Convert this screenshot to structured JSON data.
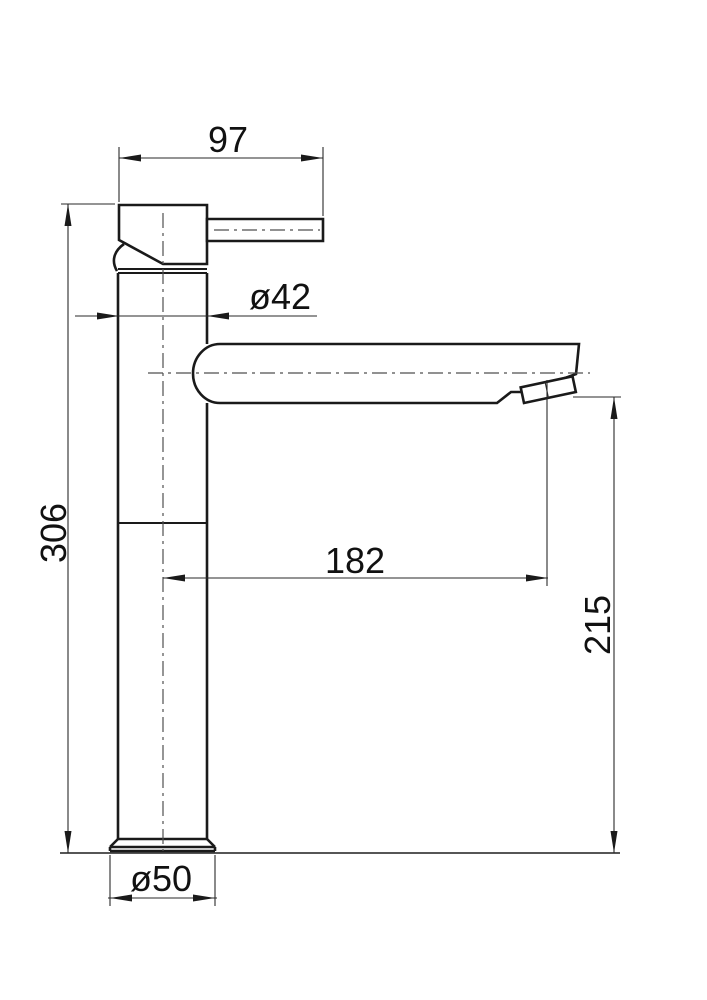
{
  "drawing": {
    "kind": "technical dimension drawing",
    "subject": "tall single-lever basin mixer faucet, side elevation",
    "background": "#ffffff",
    "line_color": "#1a1a1a",
    "centerline_color": "#4f4f4f",
    "dims": {
      "handle_length": "97",
      "body_diameter": "ø42",
      "total_height": "306",
      "spout_reach": "182",
      "outlet_height": "215",
      "base_diameter": "ø50"
    }
  }
}
